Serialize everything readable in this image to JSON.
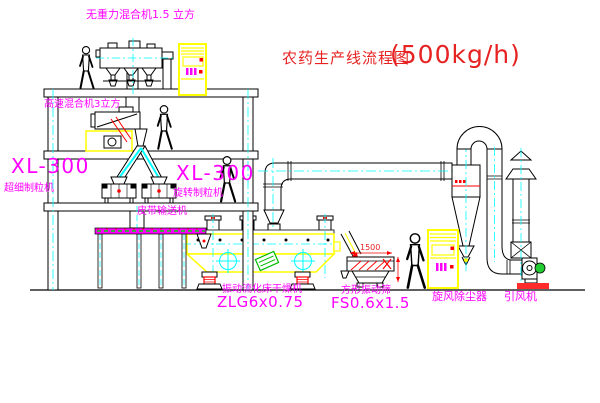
{
  "title": {
    "cn": "农药生产线流程图",
    "capacity": "(500kg/h)"
  },
  "labels": {
    "top_mixer": "无重力混合机1.5 立方",
    "high_speed_mixer": "高速混合机3立方",
    "xl300_left": "XL-300",
    "granulator_left": "超细制粒机",
    "xl300_center": "XL-300",
    "granulator_center": "旋转制粒机",
    "belt_conveyor": "皮带输送机",
    "dryer_name": "振动流化床干燥机",
    "dryer_model": "ZLG6x0.75",
    "screen_name": "方形振动筛",
    "screen_model": "FS0.6x1.5",
    "cyclone": "旋风除尘器",
    "fan": "引风机",
    "screen_dim_width": "1500"
  },
  "colors": {
    "label_magenta": "#FF00FF",
    "title_red": "#E62222",
    "machine_yellow": "#FFFF00",
    "centerline_cyan": "#00FFFF",
    "accent_red": "#FF0000",
    "accent_green": "#00CC00",
    "line_black": "#000000"
  }
}
